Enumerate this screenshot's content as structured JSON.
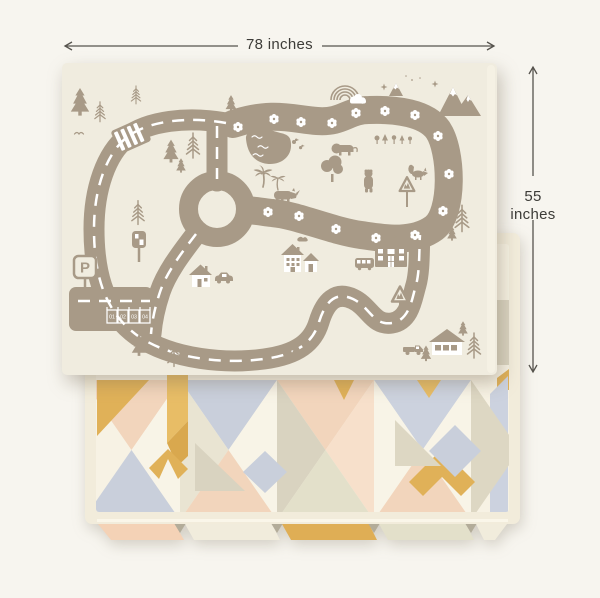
{
  "page": {
    "background_color": "#f7f5ef"
  },
  "dimensions": {
    "width_label": "78 inches",
    "height_label": "55 inches",
    "line_color": "#56534d",
    "text_color": "#3d3c38"
  },
  "road_mat": {
    "base_color": "#f0ecdf",
    "print_color": "#a89a87",
    "detail_color": "#ffffff",
    "parking_sign_label": "P",
    "parking_stalls": [
      "01",
      "02",
      "03",
      "04"
    ],
    "motifs": [
      "road-loop",
      "roundabout",
      "crosswalk",
      "parking-lot",
      "pond",
      "rainbow",
      "cloud",
      "mountains",
      "stars",
      "pine-trees",
      "palm-trees",
      "lion",
      "bear",
      "fox",
      "rhino",
      "ducks",
      "bird",
      "houses",
      "school-building",
      "bus",
      "car",
      "pickup-truck",
      "traffic-light",
      "deer-crossing-sign",
      "warning-sign",
      "flowers"
    ]
  },
  "geo_mat": {
    "border_color": "#f2ecdb",
    "base_color": "#f7f2e4",
    "palette": {
      "mustard": "#e0b158",
      "mustard_dark": "#d9a84e",
      "peach": "#f2d5bc",
      "blush": "#f7e0cb",
      "blue_gray": "#c9cfdb",
      "tan": "#d9d3c0",
      "sand": "#e9e4d2",
      "cream": "#f8f4e7"
    }
  }
}
